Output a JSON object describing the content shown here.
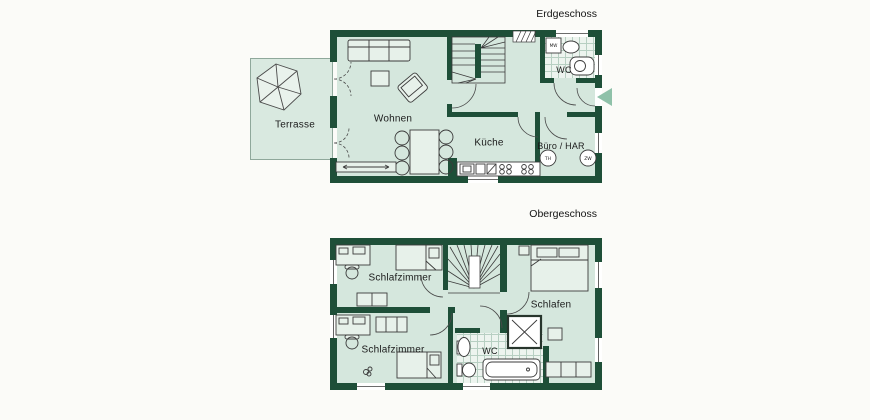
{
  "colors": {
    "wall": "#1e4f38",
    "floor": "#d5e7dd",
    "tile_line": "#b7cfc2",
    "furniture_outline": "#3b3b3b",
    "entrance_marker": "#8fc1a9",
    "background": "#fbfbf8"
  },
  "ground_floor": {
    "title": "Erdgeschoss",
    "labels": {
      "terrasse": "Terrasse",
      "wohnen": "Wohnen",
      "kueche": "Küche",
      "wc": "WC",
      "buero_har": "Büro / HAR",
      "washing_machine": "MW",
      "circle_left": "TH",
      "circle_right": "ZW"
    }
  },
  "upper_floor": {
    "title": "Obergeschoss",
    "labels": {
      "schlafzimmer_top": "Schlafzimmer",
      "schlafzimmer_bottom": "Schlafzimmer",
      "schlafen": "Schlafen",
      "wc": "WC"
    }
  }
}
